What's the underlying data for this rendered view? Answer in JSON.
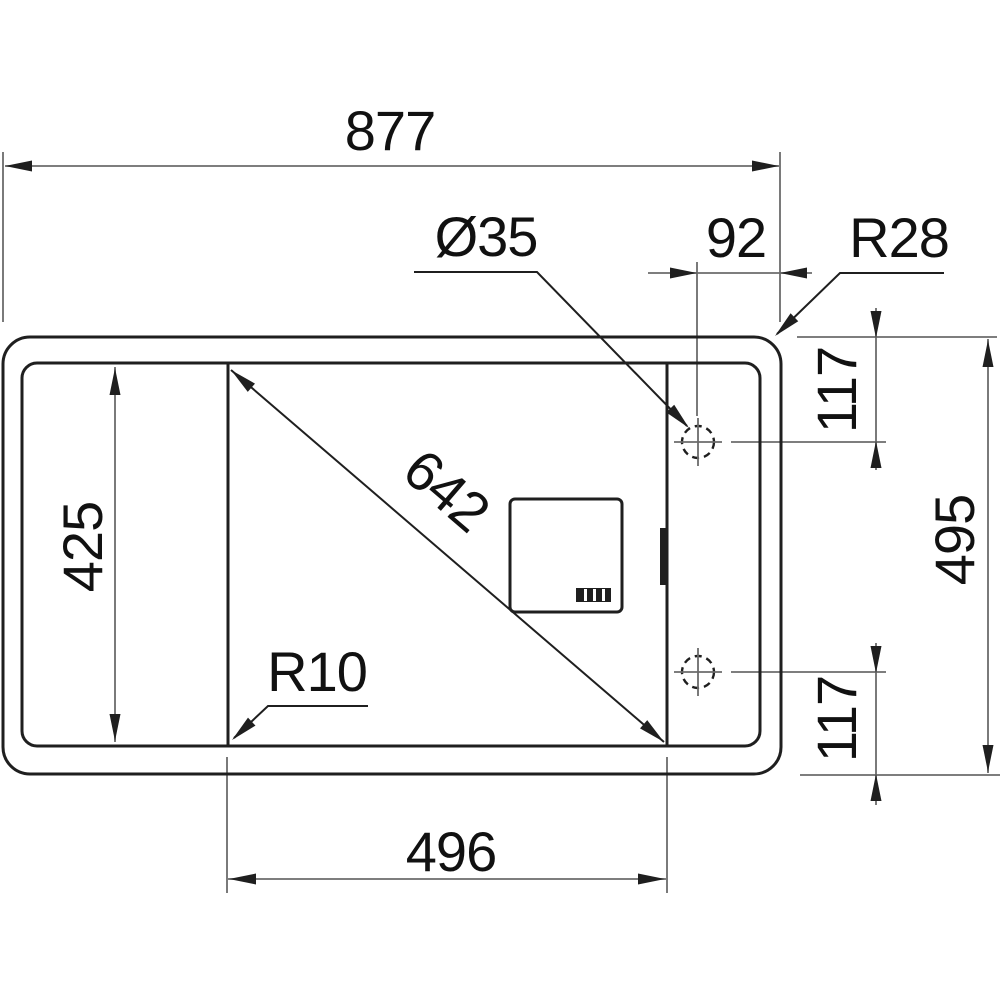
{
  "title": "Sink technical drawing, top view with installation dimensions",
  "colors": {
    "background": "#ffffff",
    "object_line": "#1f1f1f",
    "dimension_line": "#6b6b6b",
    "text": "#111111"
  },
  "dims": {
    "overall_width": {
      "label": "877"
    },
    "tap_hole_diameter": {
      "label": "Ø35"
    },
    "tap_hole_edge_offset": {
      "label": "92"
    },
    "outer_corner_radius": {
      "label": "R28"
    },
    "bowl_height": {
      "label": "425"
    },
    "bowl_diagonal": {
      "label": "642"
    },
    "bowl_corner_radius": {
      "label": "R10"
    },
    "bowl_width": {
      "label": "496"
    },
    "tap_hole_top_offset": {
      "label": "117"
    },
    "overall_depth": {
      "label": "495"
    },
    "tap_hole_bottom_offset": {
      "label": "117"
    }
  }
}
